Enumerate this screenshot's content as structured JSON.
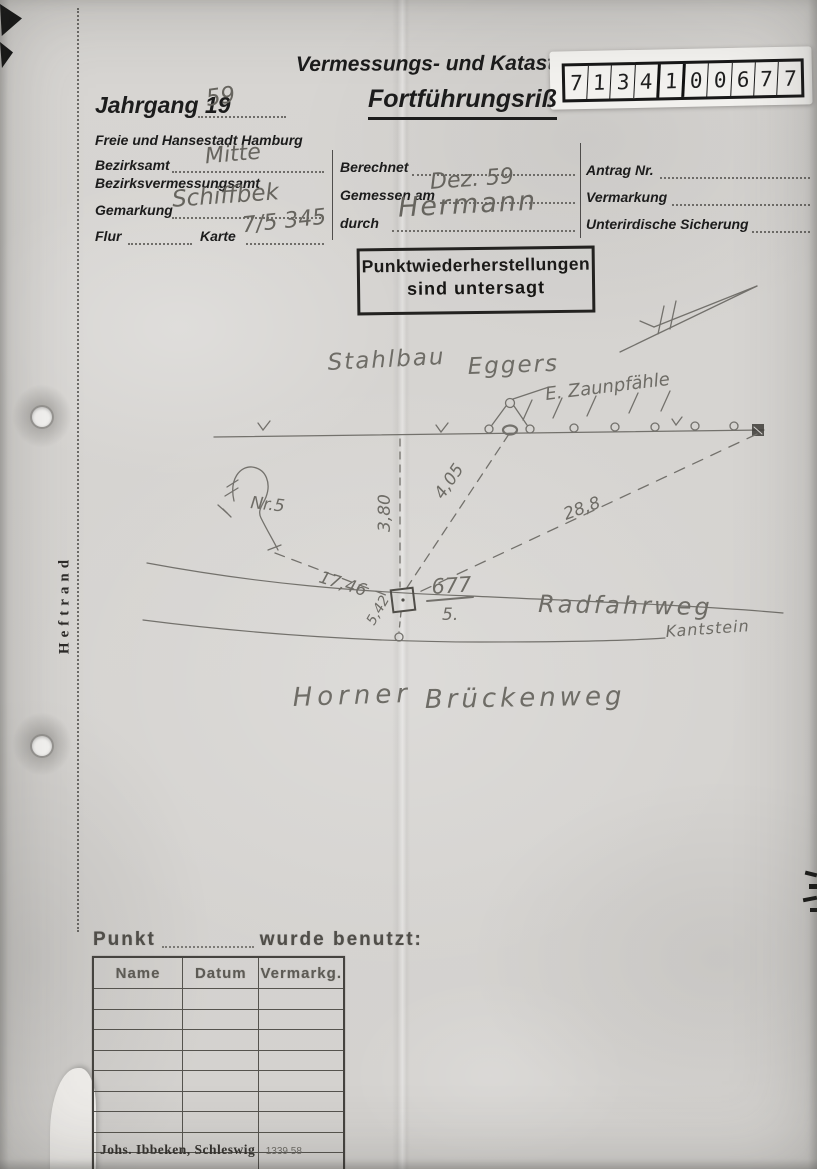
{
  "doc": {
    "header_title": "Vermessungs- und Katasterverwaltung",
    "form_title": "Fortführungsriß",
    "jahrgang_label": "Jahrgang 19",
    "jahrgang_value": "59",
    "city_line": "Freie und Hansestadt Hamburg"
  },
  "sticker": {
    "digits": [
      "7",
      "1",
      "3",
      "4",
      "1",
      "0",
      "0",
      "6",
      "7",
      "7"
    ]
  },
  "form": {
    "bezirksamt": {
      "label": "Bezirksamt",
      "value": "Mitte"
    },
    "bezirksvermessungsamt": {
      "label": "Bezirksvermessungsamt"
    },
    "gemarkung": {
      "label": "Gemarkung",
      "value": "Schiffbek"
    },
    "flur": {
      "label": "Flur"
    },
    "karte": {
      "label": "Karte",
      "value": "7/5 345"
    },
    "berechnet": {
      "label": "Berechnet",
      "value": ""
    },
    "gemessen_am": {
      "label": "Gemessen am",
      "value": "Dez. 59"
    },
    "durch": {
      "label": "durch",
      "value": "Hermann"
    },
    "antrag_nr": {
      "label": "Antrag Nr.",
      "value": ""
    },
    "vermarkung": {
      "label": "Vermarkung",
      "value": ""
    },
    "unterirdische_sicherung": {
      "label": "Unterirdische Sicherung",
      "value": ""
    }
  },
  "stamp": {
    "line1": "Punktwiederherstellungen",
    "line2": "sind untersagt"
  },
  "margin": {
    "label": "Heftrand"
  },
  "sketch": {
    "labels": {
      "stahlbau": "Stahlbau",
      "eggers": "Eggers",
      "zaunpfaehle": "E. Zaunpfähle",
      "nr5": "Nr.5",
      "m380": "3,80",
      "m405": "4,05",
      "m288": "28,8",
      "m1746": "17,46",
      "m542": "5,42",
      "parcel_num": "677",
      "parcel_den": "5.",
      "radfahrweg": "Radfahrweg",
      "kantstein": "Kantstein",
      "horner": "Horner",
      "brueckenweg": "Brückenweg"
    }
  },
  "punkt": {
    "prefix": "Punkt",
    "suffix": "wurde benutzt:",
    "table": {
      "headers": [
        "Name",
        "Datum",
        "Vermarkg."
      ],
      "rows": [
        [
          "",
          "",
          ""
        ],
        [
          "",
          "",
          ""
        ],
        [
          "",
          "",
          ""
        ],
        [
          "",
          "",
          ""
        ],
        [
          "",
          "",
          ""
        ],
        [
          "",
          "",
          ""
        ],
        [
          "",
          "",
          ""
        ],
        [
          "",
          "",
          ""
        ]
      ]
    },
    "imprint": "Johs. Ibbeken, Schleswig",
    "imprint_no": "1339 58"
  }
}
